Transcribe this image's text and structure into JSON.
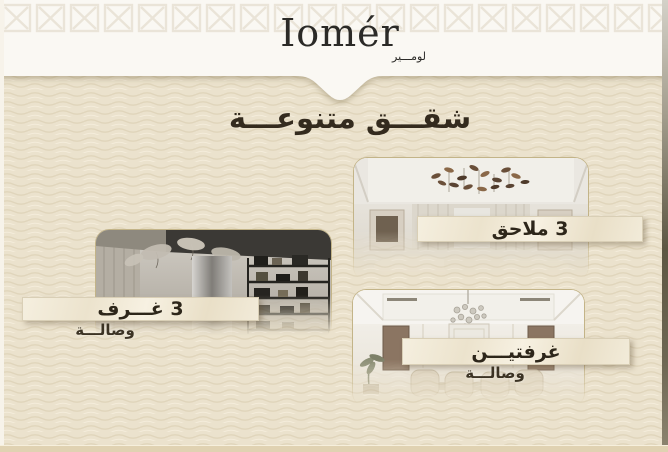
{
  "header": {
    "logo_text": "Iomér",
    "logo_arabic": "لومـــير"
  },
  "heading": {
    "title": "شقـــق متنوعـــة"
  },
  "cards": [
    {
      "id": "annexes",
      "label": "3 ملاحق",
      "sublabel": ""
    },
    {
      "id": "three-rooms",
      "label": "3 غـــرف",
      "sublabel": "وصالـــة"
    },
    {
      "id": "two-rooms",
      "label": "غرفتيـــن",
      "sublabel": "وصالـــة"
    }
  ],
  "colors": {
    "background_beige": "#ebe2cd",
    "wave_line": "#dcd0b5",
    "header_white": "#faf8f3",
    "banner_cream": "#f2ebd9",
    "text_dark": "#2d261a",
    "gold_border": "#c3b488"
  }
}
